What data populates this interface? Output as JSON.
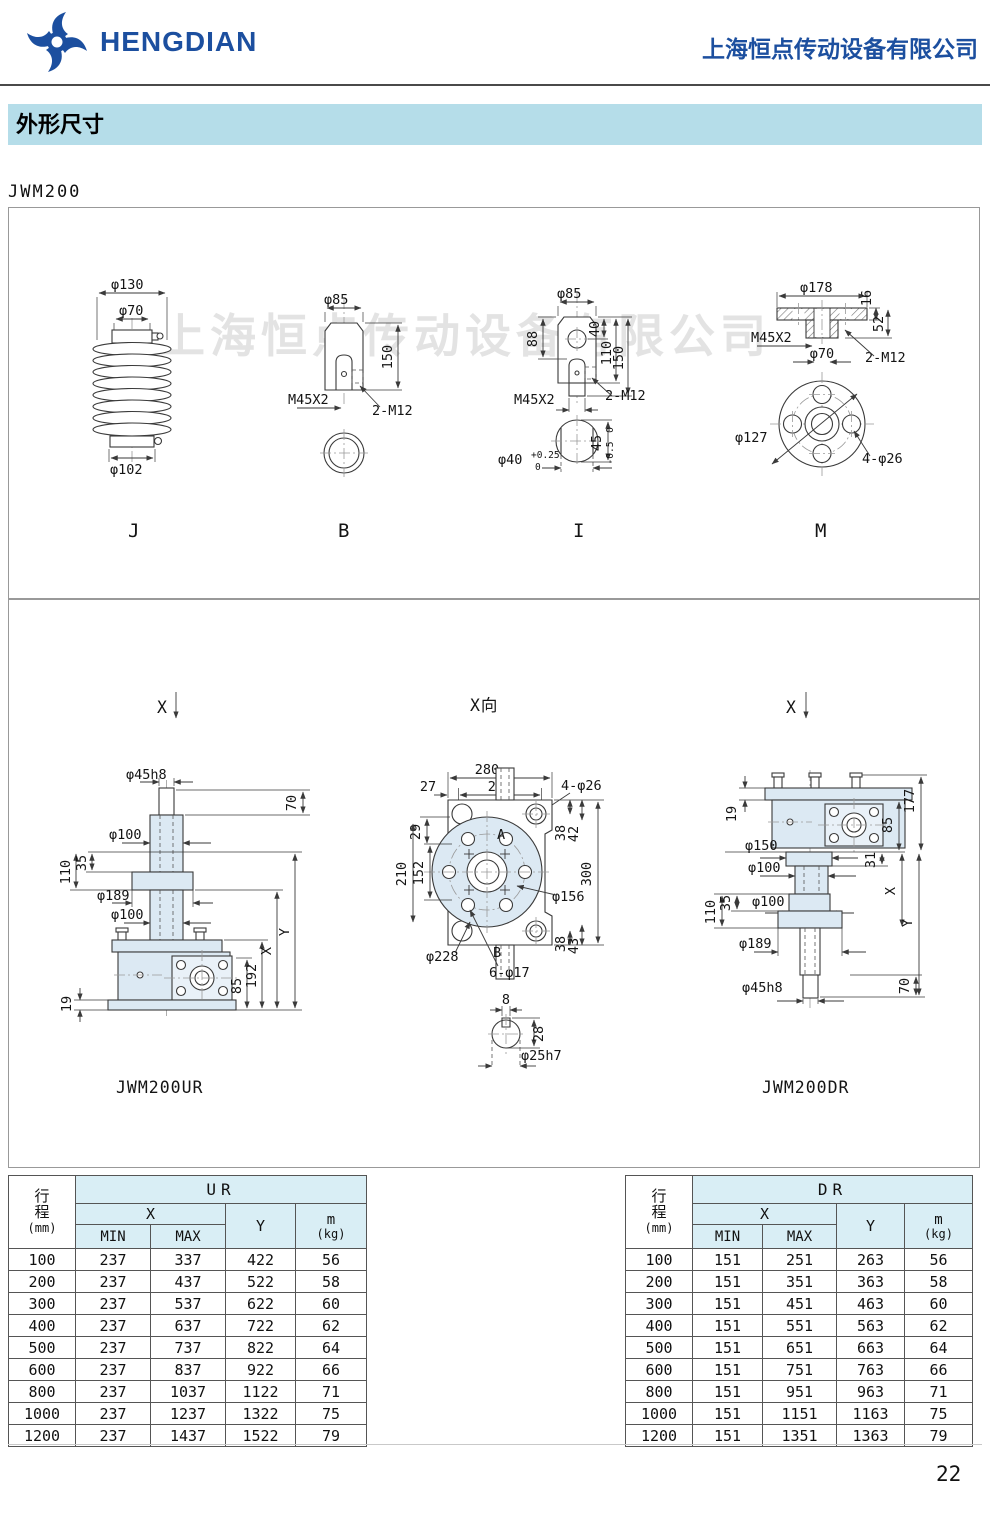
{
  "header": {
    "logo_text": "HENGDIAN",
    "company_name": "上海恒点传动设备有限公司"
  },
  "section_title": "外形尺寸",
  "model": "JWM200",
  "watermark": "上海恒点传动设备有限公司",
  "page_number": "22",
  "colors": {
    "brand_blue": "#1c4f9f",
    "banner_bg": "#b5dde9",
    "table_header_bg": "#d9eef5",
    "drawing_fill": "#dce9f3"
  },
  "drawings": {
    "j": {
      "label": "J",
      "dims": [
        "φ130",
        "φ70",
        "φ102"
      ]
    },
    "b": {
      "label": "B",
      "dims": [
        "φ85",
        "150",
        "M45X2",
        "2-M12"
      ]
    },
    "i": {
      "label": "I",
      "dims": [
        "φ85",
        "88",
        "40",
        "110",
        "150",
        "M45X2",
        "2-M12",
        "φ40",
        "+0.25",
        "0",
        "45",
        "0",
        "-0.5"
      ]
    },
    "m": {
      "label": "M",
      "dims": [
        "φ178",
        "16",
        "52",
        "M45X2",
        "φ70",
        "2-M12",
        "φ127",
        "4-φ26"
      ]
    },
    "ur": {
      "view": "X",
      "name": "JWM200UR",
      "dims": [
        "φ45h8",
        "70",
        "φ100",
        "110",
        "35",
        "φ189",
        "φ100",
        "19",
        "85",
        "192",
        "X",
        "Y"
      ]
    },
    "xv": {
      "view": "X向",
      "dims": [
        "280",
        "222",
        "27",
        "77",
        "73",
        "4-φ26",
        "29",
        "210",
        "152",
        "A",
        "B",
        "38",
        "42",
        "38",
        "43",
        "φ156",
        "300",
        "φ228",
        "6-φ17",
        "8",
        "28",
        "φ25h7"
      ]
    },
    "dr": {
      "view": "X",
      "name": "JWM200DR",
      "dims": [
        "19",
        "177",
        "85",
        "φ150",
        "31",
        "φ100",
        "110",
        "35",
        "φ100",
        "φ189",
        "70",
        "φ45h8",
        "X",
        "Y"
      ]
    }
  },
  "tables": [
    {
      "group": "UR",
      "col_stroke": [
        "行",
        "程"
      ],
      "col_stroke_unit": "(mm)",
      "col_x": "X",
      "col_min": "MIN",
      "col_max": "MAX",
      "col_y": "Y",
      "col_m": "m",
      "col_m_unit": "(kg)",
      "rows": [
        [
          "100",
          "237",
          "337",
          "422",
          "56"
        ],
        [
          "200",
          "237",
          "437",
          "522",
          "58"
        ],
        [
          "300",
          "237",
          "537",
          "622",
          "60"
        ],
        [
          "400",
          "237",
          "637",
          "722",
          "62"
        ],
        [
          "500",
          "237",
          "737",
          "822",
          "64"
        ],
        [
          "600",
          "237",
          "837",
          "922",
          "66"
        ],
        [
          "800",
          "237",
          "1037",
          "1122",
          "71"
        ],
        [
          "1000",
          "237",
          "1237",
          "1322",
          "75"
        ],
        [
          "1200",
          "237",
          "1437",
          "1522",
          "79"
        ]
      ]
    },
    {
      "group": "DR",
      "col_stroke": [
        "行",
        "程"
      ],
      "col_stroke_unit": "(mm)",
      "col_x": "X",
      "col_min": "MIN",
      "col_max": "MAX",
      "col_y": "Y",
      "col_m": "m",
      "col_m_unit": "(kg)",
      "rows": [
        [
          "100",
          "151",
          "251",
          "263",
          "56"
        ],
        [
          "200",
          "151",
          "351",
          "363",
          "58"
        ],
        [
          "300",
          "151",
          "451",
          "463",
          "60"
        ],
        [
          "400",
          "151",
          "551",
          "563",
          "62"
        ],
        [
          "500",
          "151",
          "651",
          "663",
          "64"
        ],
        [
          "600",
          "151",
          "751",
          "763",
          "66"
        ],
        [
          "800",
          "151",
          "951",
          "963",
          "71"
        ],
        [
          "1000",
          "151",
          "1151",
          "1163",
          "75"
        ],
        [
          "1200",
          "151",
          "1351",
          "1363",
          "79"
        ]
      ]
    }
  ]
}
